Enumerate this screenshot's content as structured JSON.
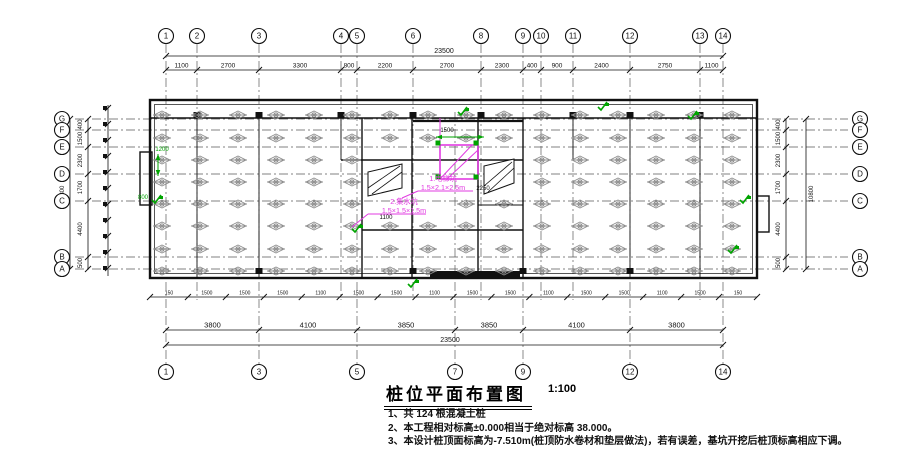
{
  "drawing": {
    "title": "桩位平面布置图",
    "scale": "1:100",
    "notes": [
      "1、共 124 根混凝土桩",
      "2、本工程相对标高±0.000相当于绝对标高 38.000。",
      "3、本设计桩顶面标高为-7.510m(桩顶防水卷材和垫层做法)，若有误差，基坑开挖后桩顶标高相应下调。"
    ]
  },
  "axes": {
    "vertical": [
      {
        "label": "1",
        "x": 166,
        "top": true,
        "bottom": true
      },
      {
        "label": "2",
        "x": 197,
        "top": true,
        "bottom": false
      },
      {
        "label": "3",
        "x": 259,
        "top": true,
        "bottom": true
      },
      {
        "label": "4",
        "x": 341,
        "top": true,
        "bottom": false
      },
      {
        "label": "5",
        "x": 357,
        "top": true,
        "bottom": true
      },
      {
        "label": "6",
        "x": 413,
        "top": true,
        "bottom": false
      },
      {
        "label": "7",
        "x": 455,
        "top": false,
        "bottom": true
      },
      {
        "label": "8",
        "x": 481,
        "top": true,
        "bottom": false
      },
      {
        "label": "9",
        "x": 523,
        "top": true,
        "bottom": true
      },
      {
        "label": "10",
        "x": 541,
        "top": true,
        "bottom": false
      },
      {
        "label": "11",
        "x": 573,
        "top": true,
        "bottom": false
      },
      {
        "label": "12",
        "x": 630,
        "top": true,
        "bottom": true
      },
      {
        "label": "13",
        "x": 700,
        "top": true,
        "bottom": false
      },
      {
        "label": "14",
        "x": 723,
        "top": true,
        "bottom": true
      }
    ],
    "horizontal": [
      {
        "label": "G",
        "y": 119
      },
      {
        "label": "F",
        "y": 130
      },
      {
        "label": "E",
        "y": 147
      },
      {
        "label": "D",
        "y": 174
      },
      {
        "label": "C",
        "y": 201
      },
      {
        "label": "B",
        "y": 257
      },
      {
        "label": "A",
        "y": 269
      }
    ]
  },
  "dims": {
    "top": {
      "overall": "23500",
      "segments": [
        "1100",
        "2700",
        "3300",
        "800",
        "2200",
        "2700",
        "2300",
        "400",
        "900",
        "2400",
        "2750",
        "1100"
      ]
    },
    "bottom": {
      "overall": "23500",
      "segments": [
        "3800",
        "4100",
        "3850",
        "3850",
        "4100",
        "3800"
      ],
      "minor": [
        "150",
        "1500",
        "1500",
        "1500",
        "1100",
        "1500",
        "1500",
        "1100",
        "1500",
        "1500",
        "1100",
        "1500",
        "1500",
        "1100",
        "1500",
        "150"
      ]
    },
    "side": {
      "overall": "10800",
      "segments": [
        "400",
        "1500",
        "2300",
        "1700",
        "4400",
        "500"
      ]
    }
  },
  "annotations": {
    "pits": [
      {
        "lines": [
          "1.电梯坑",
          "1.5×2.1×2.5m"
        ]
      },
      {
        "lines": [
          "2.集水坑",
          "1.5×1.5×1.5m"
        ]
      }
    ],
    "tiny_black": [
      {
        "text": "1500",
        "x": 447,
        "y": 132
      },
      {
        "text": "2250",
        "x": 483,
        "y": 190
      },
      {
        "text": "1100",
        "x": 386,
        "y": 219
      }
    ],
    "tiny_green": [
      {
        "text": "1200",
        "x": 162,
        "y": 151
      },
      {
        "text": "800",
        "x": 143,
        "y": 199
      }
    ]
  },
  "colors": {
    "line": "#111111",
    "grid": "#5a5a5a",
    "pile": "#8d8d8d",
    "selection": "#e23be2",
    "check": "#00a400"
  }
}
